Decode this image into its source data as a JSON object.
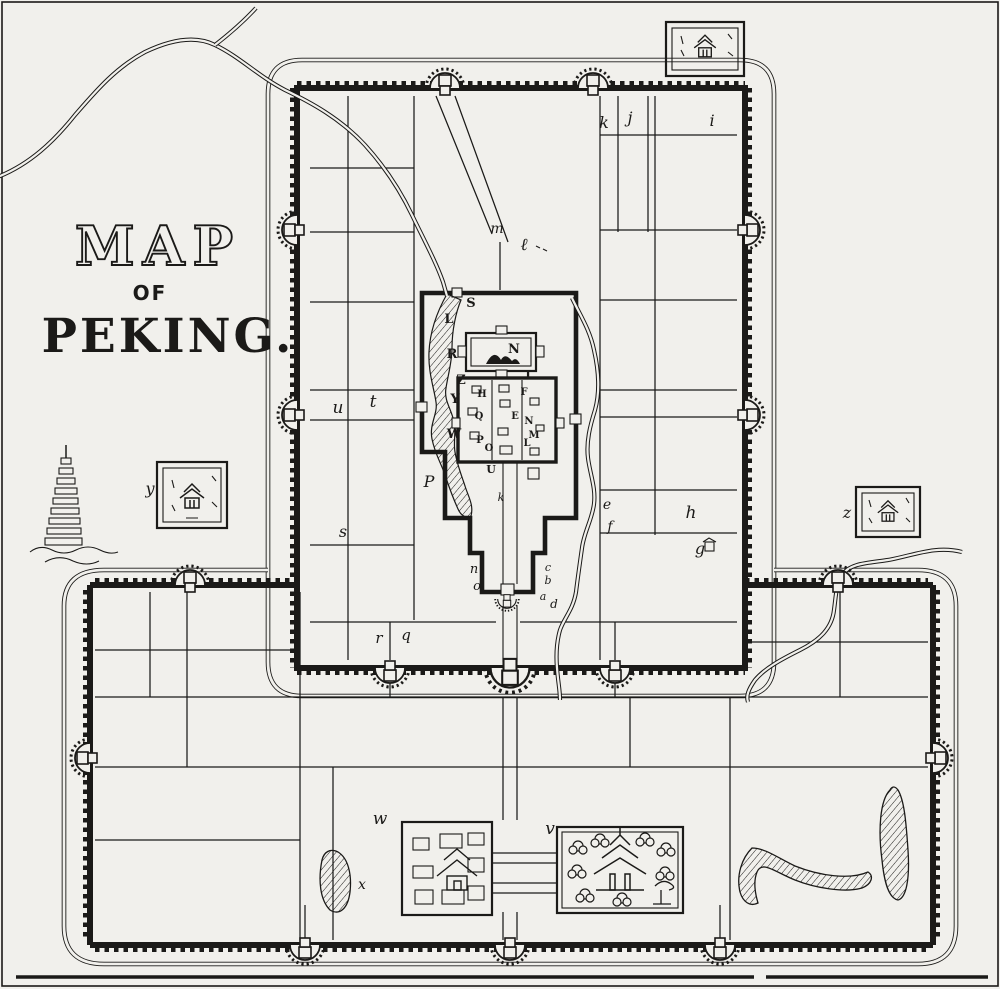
{
  "title": {
    "map": "MAP",
    "of": "OF",
    "peking": "PEKING."
  },
  "colors": {
    "ink": "#1b1a18",
    "paper": "#f1f0ec"
  },
  "labels": {
    "tartar": {
      "k": "k",
      "j": "j",
      "i": "i",
      "m": "m",
      "l": "ℓ",
      "u": "u",
      "t": "t",
      "s": "s",
      "p": "P",
      "e": "e",
      "f": "f",
      "h": "h",
      "g": "g",
      "n": "n",
      "o": "o",
      "c": "c",
      "b": "b",
      "a": "a",
      "d": "d",
      "r": "r",
      "q": "q"
    },
    "imperial": {
      "s": "S",
      "l": "L",
      "r": "R",
      "z": "Z",
      "y": "Y",
      "w": "W",
      "n": "N",
      "i": "I"
    },
    "forbidden": {
      "h": "H",
      "q": "Q",
      "p": "P",
      "o": "O",
      "f": "F",
      "e": "E",
      "n": "N",
      "m": "M",
      "l": "L",
      "u": "U",
      "k": "k"
    },
    "chinese": {
      "w": "w",
      "v": "v",
      "x": "x"
    },
    "insets": {
      "y": "y",
      "z": "z"
    }
  }
}
